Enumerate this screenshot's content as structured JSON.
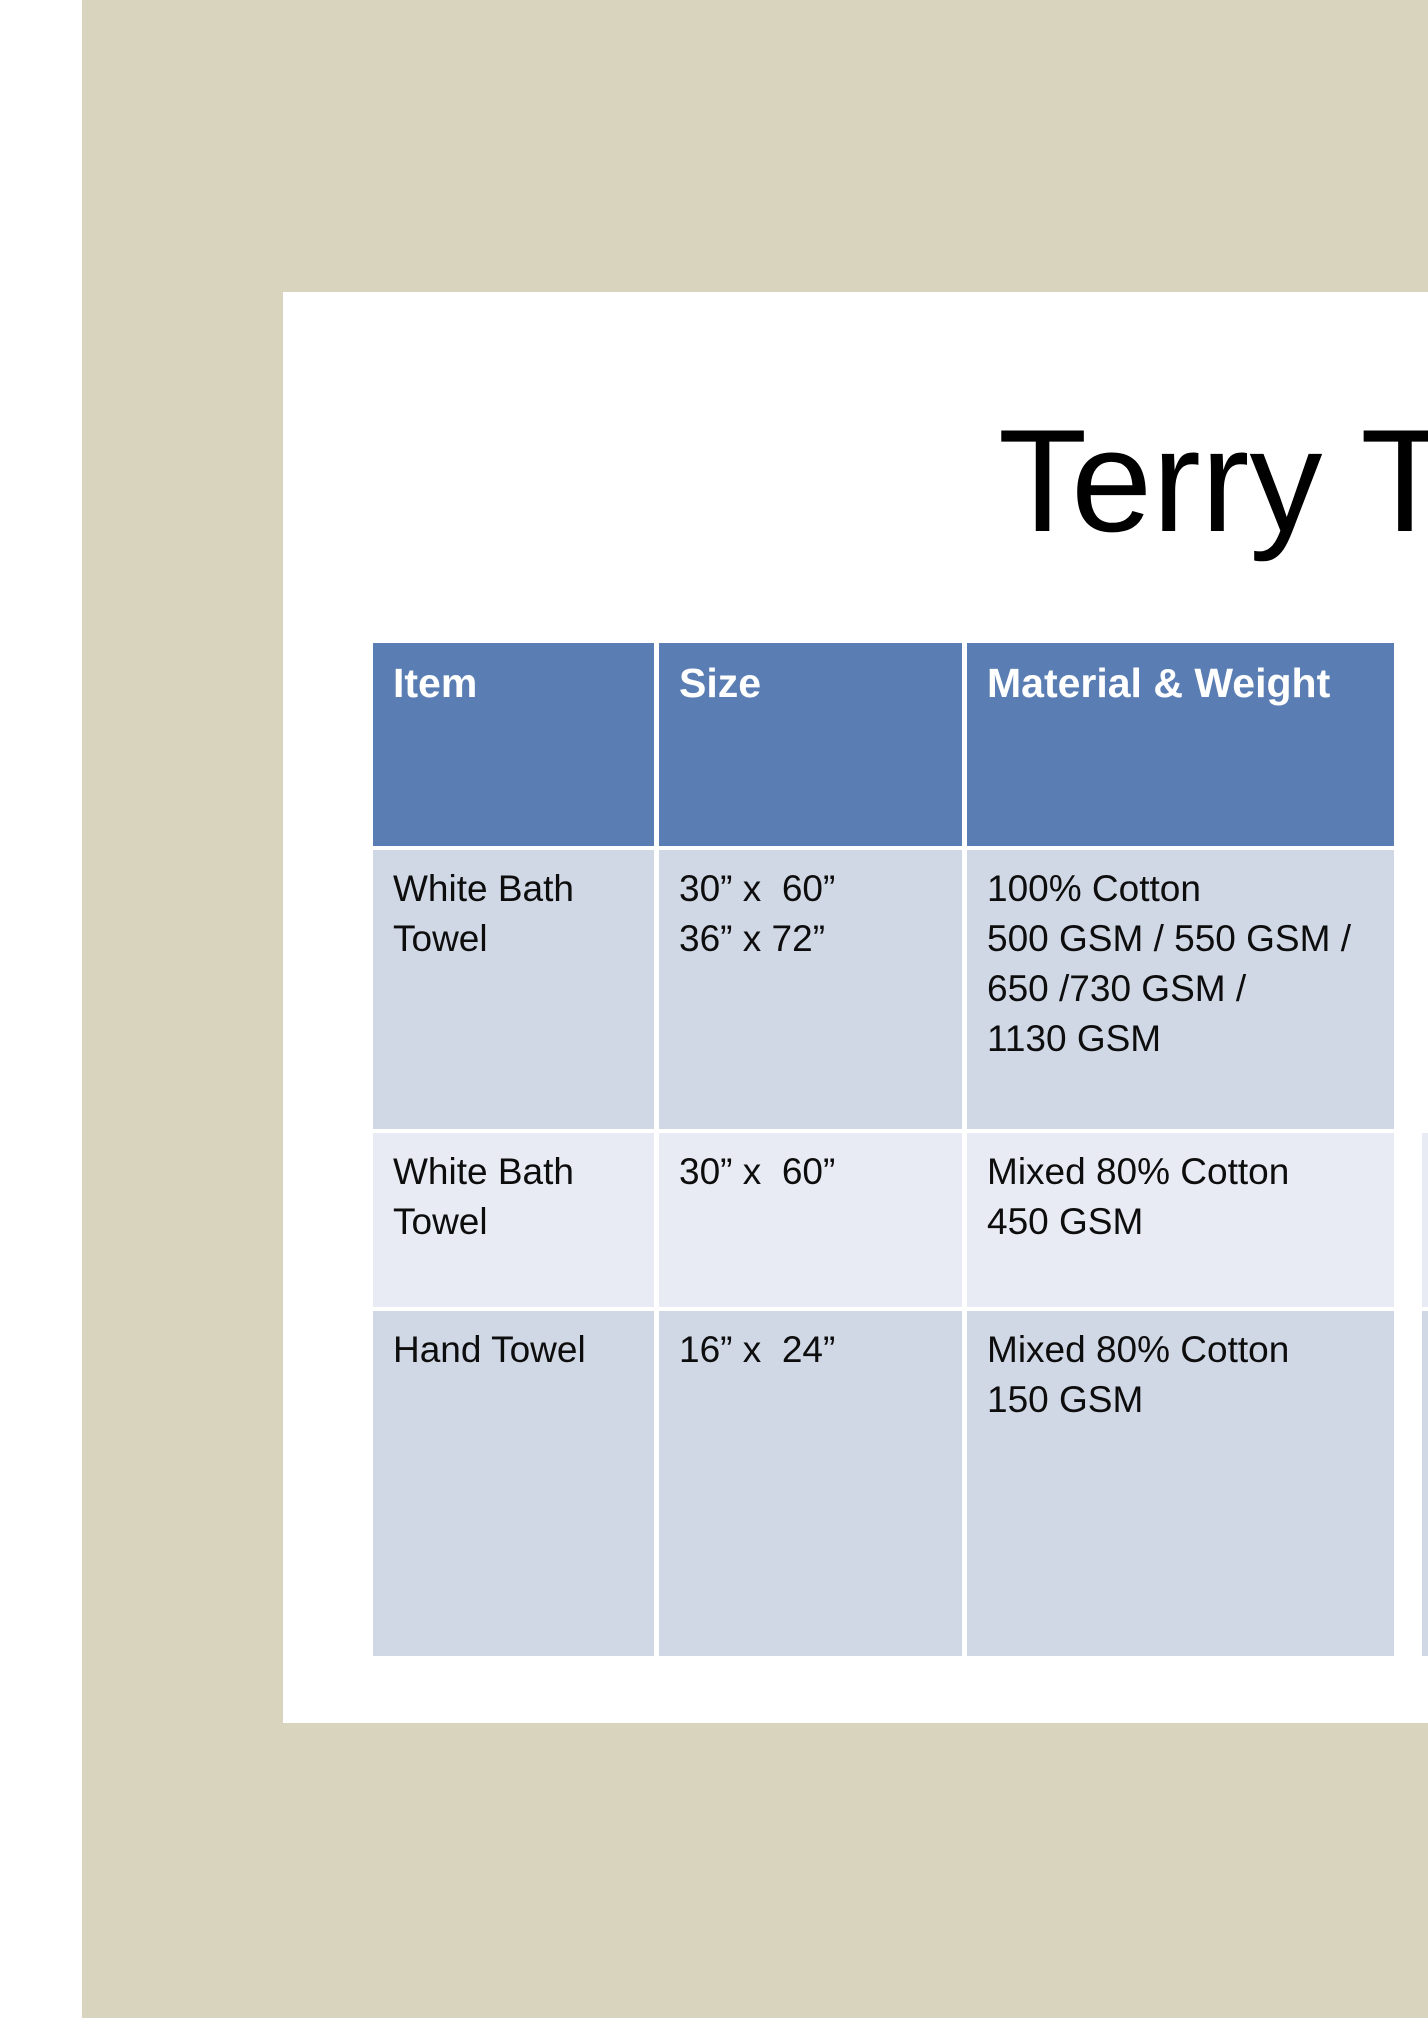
{
  "title": "Terry T",
  "colors": {
    "beige": "#d9d4bd",
    "header_blue": "#5a7eb3",
    "row_light": "#d0d7e5",
    "row_lighter": "#e8ebf4",
    "header_text": "#ffffff",
    "body_text": "#0d0d0d"
  },
  "table": {
    "headers": [
      "Item",
      "Size",
      "Material & Weight"
    ],
    "rows": [
      {
        "item": [
          "White Bath",
          "Towel"
        ],
        "size": [
          "30” x  60”",
          "36” x 72”"
        ],
        "material": [
          "100% Cotton",
          "500 GSM / 550 GSM /",
          "650 /730 GSM /",
          "1130 GSM"
        ]
      },
      {
        "item": [
          "White Bath",
          "Towel"
        ],
        "size": [
          "30” x  60”"
        ],
        "material": [
          "Mixed 80% Cotton",
          "450 GSM"
        ]
      },
      {
        "item": [
          "Hand Towel"
        ],
        "size": [
          "16” x  24”"
        ],
        "material": [
          "Mixed 80% Cotton",
          "150 GSM"
        ]
      }
    ]
  }
}
